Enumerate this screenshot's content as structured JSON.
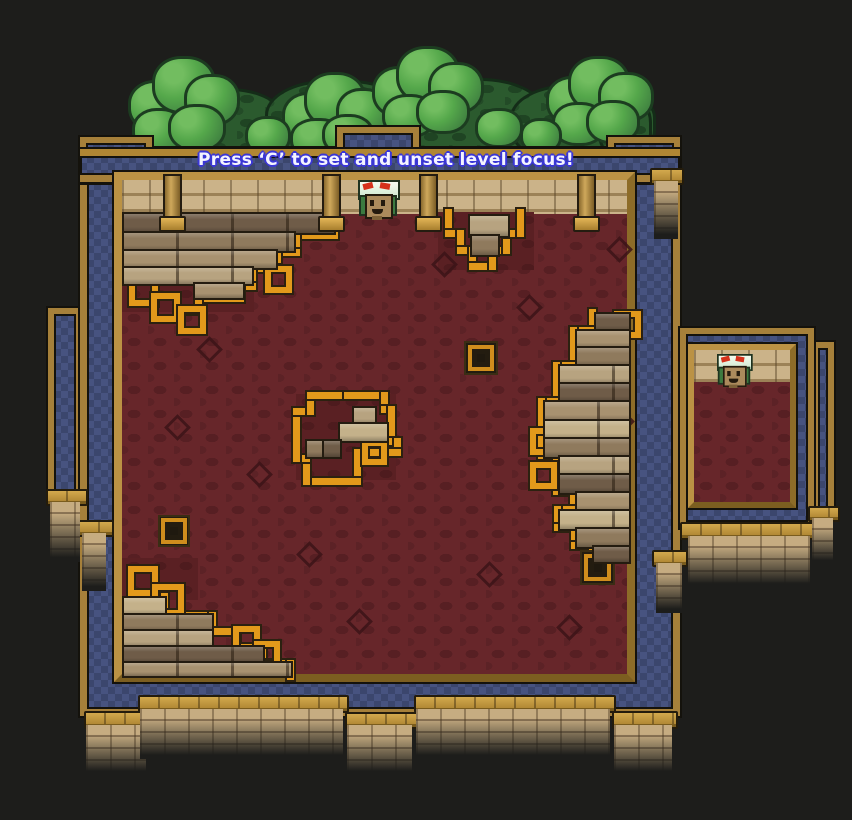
{
  "hud": {
    "message": "Press ‘C’ to set and unset level focus!"
  },
  "palette": {
    "background": "#1d1d1b",
    "wall_blue": "#475380",
    "trim_gold": "#a6803a",
    "accent_orange": "#e2991b",
    "interior_red": "#67262a",
    "brick_tan": "#c6ac81",
    "tree_green": "#3f8040",
    "text_color": "#f4f4ff",
    "text_outline_blue": "#3a36d6"
  },
  "scene": {
    "trees": {
      "dark_puffs": [
        [
          150,
          88,
          130,
          70
        ],
        [
          265,
          80,
          140,
          78
        ],
        [
          390,
          78,
          150,
          78
        ],
        [
          510,
          84,
          140,
          74
        ],
        [
          598,
          95,
          48,
          60
        ]
      ],
      "bright_puffs": [
        [
          128,
          80,
          52,
          46
        ],
        [
          152,
          56,
          58,
          52
        ],
        [
          184,
          74,
          50,
          46
        ],
        [
          132,
          108,
          48,
          40
        ],
        [
          168,
          104,
          52,
          42
        ],
        [
          282,
          92,
          50,
          44
        ],
        [
          304,
          72,
          56,
          50
        ],
        [
          336,
          88,
          48,
          44
        ],
        [
          290,
          118,
          50,
          36
        ],
        [
          322,
          114,
          46,
          36
        ],
        [
          372,
          66,
          52,
          46
        ],
        [
          396,
          46,
          58,
          52
        ],
        [
          428,
          62,
          50,
          46
        ],
        [
          382,
          94,
          48,
          38
        ],
        [
          416,
          90,
          48,
          38
        ],
        [
          546,
          76,
          50,
          44
        ],
        [
          568,
          56,
          56,
          50
        ],
        [
          598,
          72,
          50,
          44
        ],
        [
          552,
          102,
          48,
          38
        ],
        [
          586,
          100,
          48,
          38
        ],
        [
          245,
          116,
          40,
          34
        ],
        [
          475,
          108,
          42,
          34
        ],
        [
          520,
          118,
          36,
          30
        ]
      ]
    },
    "building": {
      "wall": [
        80,
        148,
        600,
        568
      ],
      "corner_blocks": [
        [
          80,
          137,
          72,
          46
        ],
        [
          608,
          137,
          72,
          46
        ]
      ],
      "notch": [
        337,
        127,
        82,
        48
      ],
      "band": [
        80,
        149,
        600,
        33
      ],
      "room_frame": [
        114,
        172,
        521,
        510
      ],
      "ceiling": [
        122,
        180,
        505,
        34
      ],
      "red_floor": [
        122,
        214,
        505,
        460
      ]
    },
    "side_panels": [
      [
        48,
        308,
        34,
        194
      ],
      [
        80,
        293,
        28,
        240
      ],
      [
        812,
        342,
        22,
        172
      ]
    ],
    "small_room": {
      "frame": [
        680,
        328,
        134,
        200
      ],
      "room_frame": [
        688,
        344,
        108,
        164
      ],
      "ceiling": [
        694,
        350,
        96,
        32
      ],
      "red_floor": [
        694,
        382,
        96,
        120
      ]
    },
    "red_patches": [
      [
        438,
        212,
        96,
        58
      ],
      [
        296,
        394,
        100,
        86
      ],
      [
        340,
        394,
        56,
        58
      ],
      [
        122,
        262,
        132,
        50
      ],
      [
        122,
        558,
        76,
        42
      ],
      [
        738,
        382,
        54,
        118
      ]
    ],
    "diamonds": [
      [
        200,
        340
      ],
      [
        435,
        255
      ],
      [
        610,
        240
      ],
      [
        250,
        465
      ],
      [
        480,
        565
      ],
      [
        350,
        612
      ],
      [
        560,
        618
      ],
      [
        168,
        418
      ],
      [
        612,
        412
      ],
      [
        300,
        545
      ],
      [
        520,
        298
      ],
      [
        230,
        250
      ],
      [
        733,
        444
      ]
    ],
    "trims": [
      {
        "name": "left-structure-trim",
        "pts": [
          [
            334,
            212
          ],
          [
            334,
            235
          ],
          [
            296,
            235
          ],
          [
            296,
            252
          ],
          [
            277,
            252
          ],
          [
            277,
            268
          ],
          [
            252,
            268
          ],
          [
            252,
            286
          ],
          [
            240,
            286
          ],
          [
            240,
            298
          ],
          [
            198,
            298
          ],
          [
            198,
            310
          ],
          [
            186,
            310
          ]
        ]
      },
      {
        "name": "top-middle-trim",
        "pts": [
          [
            448,
            212
          ],
          [
            448,
            233
          ],
          [
            460,
            233
          ],
          [
            460,
            250
          ],
          [
            472,
            250
          ],
          [
            472,
            266
          ],
          [
            492,
            266
          ],
          [
            492,
            250
          ],
          [
            506,
            250
          ],
          [
            506,
            233
          ],
          [
            520,
            233
          ],
          [
            520,
            212
          ]
        ]
      },
      {
        "name": "center-island-trim",
        "pts": [
          [
            338,
            395
          ],
          [
            384,
            395
          ],
          [
            384,
            409
          ],
          [
            391,
            409
          ],
          [
            391,
            441
          ],
          [
            397,
            441
          ],
          [
            397,
            452
          ],
          [
            357,
            452
          ],
          [
            357,
            481
          ],
          [
            306,
            481
          ],
          [
            306,
            458
          ],
          [
            296,
            458
          ],
          [
            296,
            411
          ],
          [
            310,
            411
          ],
          [
            310,
            395
          ],
          [
            338,
            395
          ]
        ]
      },
      {
        "name": "right-stack-trim",
        "pts": [
          [
            592,
            312
          ],
          [
            592,
            330
          ],
          [
            573,
            330
          ],
          [
            573,
            365
          ],
          [
            556,
            365
          ],
          [
            556,
            401
          ],
          [
            541,
            401
          ],
          [
            541,
            455
          ],
          [
            556,
            455
          ],
          [
            556,
            491
          ],
          [
            573,
            491
          ],
          [
            573,
            509
          ],
          [
            557,
            509
          ],
          [
            557,
            527
          ],
          [
            574,
            527
          ],
          [
            574,
            545
          ],
          [
            592,
            545
          ],
          [
            592,
            562
          ]
        ]
      },
      {
        "name": "bottom-stairs-trim",
        "pts": [
          [
            148,
            596
          ],
          [
            164,
            596
          ],
          [
            164,
            615
          ],
          [
            212,
            615
          ],
          [
            212,
            631
          ],
          [
            236,
            631
          ],
          [
            236,
            647
          ],
          [
            262,
            647
          ],
          [
            262,
            663
          ],
          [
            290,
            663
          ],
          [
            290,
            676
          ]
        ]
      },
      {
        "name": "small-room-trim",
        "pts": [
          [
            745,
            384
          ],
          [
            745,
            399
          ],
          [
            758,
            399
          ],
          [
            758,
            414
          ],
          [
            748,
            414
          ],
          [
            748,
            430
          ],
          [
            762,
            430
          ],
          [
            762,
            446
          ],
          [
            744,
            446
          ],
          [
            744,
            462
          ],
          [
            758,
            462
          ],
          [
            758,
            478
          ],
          [
            744,
            478
          ],
          [
            744,
            494
          ],
          [
            760,
            494
          ],
          [
            760,
            500
          ]
        ]
      }
    ],
    "trim_hollows": [
      [
        129,
        277,
        17
      ],
      [
        151,
        293,
        17
      ],
      [
        178,
        306,
        16
      ],
      [
        265,
        266,
        15
      ],
      [
        128,
        566,
        18
      ],
      [
        152,
        584,
        20
      ],
      [
        233,
        626,
        15
      ],
      [
        254,
        641,
        14
      ],
      [
        614,
        311,
        15
      ],
      [
        530,
        428,
        15
      ],
      [
        530,
        462,
        15
      ],
      [
        362,
        440,
        13
      ]
    ],
    "deco_squares": [
      [
        466,
        343,
        30
      ],
      [
        160,
        517,
        28
      ],
      [
        582,
        552,
        31
      ]
    ],
    "plank_shades": [
      "#6f5c48",
      "#8f7a5d",
      "#a89270",
      "#b7a380",
      "#c4b18a"
    ],
    "planks": [
      [
        122,
        212,
        210,
        19,
        0
      ],
      [
        122,
        231,
        170,
        18,
        1
      ],
      [
        122,
        249,
        152,
        17,
        2
      ],
      [
        122,
        266,
        128,
        16,
        3
      ],
      [
        193,
        282,
        48,
        14,
        2
      ],
      [
        468,
        214,
        38,
        20,
        3
      ],
      [
        470,
        234,
        26,
        19,
        1
      ],
      [
        352,
        406,
        21,
        16,
        3
      ],
      [
        338,
        422,
        47,
        17,
        4
      ],
      [
        305,
        439,
        17,
        16,
        1
      ],
      [
        322,
        439,
        16,
        16,
        0
      ],
      [
        594,
        312,
        33,
        17,
        0
      ],
      [
        575,
        329,
        52,
        17,
        2
      ],
      [
        575,
        346,
        52,
        18,
        1
      ],
      [
        558,
        364,
        69,
        18,
        3
      ],
      [
        558,
        382,
        69,
        18,
        0
      ],
      [
        543,
        400,
        84,
        19,
        2
      ],
      [
        543,
        419,
        84,
        18,
        4
      ],
      [
        543,
        437,
        84,
        18,
        1
      ],
      [
        558,
        455,
        69,
        18,
        3
      ],
      [
        558,
        473,
        69,
        18,
        0
      ],
      [
        575,
        491,
        52,
        18,
        2
      ],
      [
        558,
        509,
        69,
        18,
        4
      ],
      [
        575,
        527,
        52,
        18,
        1
      ],
      [
        592,
        545,
        35,
        15,
        0
      ],
      [
        122,
        596,
        41,
        17,
        4
      ],
      [
        122,
        613,
        88,
        16,
        1
      ],
      [
        122,
        629,
        88,
        16,
        3
      ],
      [
        122,
        645,
        139,
        16,
        0
      ],
      [
        122,
        661,
        167,
        13,
        2
      ],
      [
        770,
        384,
        20,
        15,
        1
      ],
      [
        755,
        399,
        35,
        16,
        3
      ],
      [
        752,
        415,
        38,
        16,
        0
      ],
      [
        768,
        431,
        22,
        15,
        2
      ],
      [
        766,
        446,
        24,
        16,
        1
      ],
      [
        764,
        462,
        26,
        16,
        3
      ],
      [
        770,
        478,
        20,
        14,
        0
      ]
    ],
    "pillars": [
      [
        163,
        174
      ],
      [
        322,
        174
      ],
      [
        419,
        174
      ],
      [
        577,
        174
      ]
    ],
    "ledges": [
      [
        84,
        711,
        64,
        14
      ],
      [
        345,
        712,
        69,
        13
      ],
      [
        612,
        711,
        62,
        14
      ],
      [
        138,
        695,
        207,
        14
      ],
      [
        414,
        695,
        198,
        14
      ],
      [
        46,
        489,
        38,
        13
      ],
      [
        78,
        520,
        32,
        13
      ],
      [
        650,
        168,
        30,
        13
      ],
      [
        652,
        550,
        32,
        13
      ],
      [
        680,
        522,
        134,
        14
      ],
      [
        808,
        506,
        28,
        12
      ]
    ],
    "brick_columns": [
      [
        86,
        725,
        60,
        50
      ],
      [
        347,
        725,
        65,
        50
      ],
      [
        614,
        725,
        58,
        50
      ],
      [
        140,
        709,
        203,
        50
      ],
      [
        416,
        709,
        194,
        50
      ],
      [
        50,
        502,
        30,
        60
      ],
      [
        82,
        533,
        24,
        58
      ],
      [
        654,
        181,
        24,
        58
      ],
      [
        656,
        563,
        26,
        50
      ],
      [
        688,
        536,
        122,
        52
      ],
      [
        812,
        518,
        21,
        46
      ]
    ],
    "characters": [
      {
        "x": 358,
        "y": 180,
        "s": 1
      },
      {
        "x": 717,
        "y": 354,
        "s": 0.85
      }
    ]
  }
}
